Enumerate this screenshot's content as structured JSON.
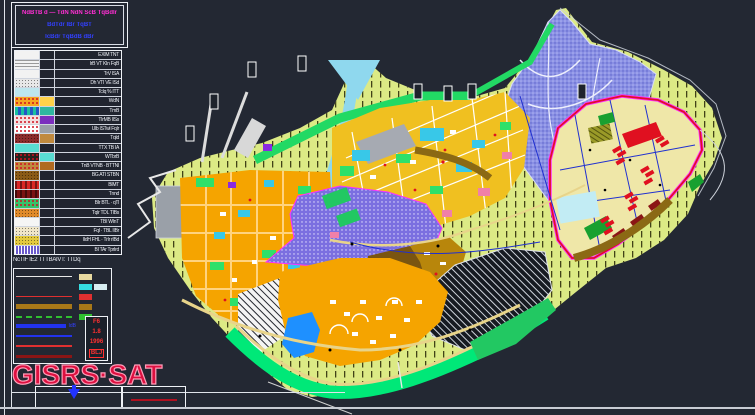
{
  "sheet": {
    "background": "#232833",
    "frame_color": "#e4e8ef"
  },
  "title_block": {
    "line1": "NdBTB d — TdN NdN ScB TqBdIr",
    "line2": "BdTdr IBr TqBT",
    "line3": "IcBdr TqBdB dBr",
    "line1_color": "#ff2fd4",
    "line23_color": "#3240ff"
  },
  "legend": {
    "rows": [
      {
        "c1": "#f2f2f2",
        "p1": "plain",
        "c2": null,
        "label": "EXIM TNT"
      },
      {
        "c1": "#f2f2f2",
        "p1": "hlines",
        "c2": null,
        "label": "IrB VT KIn FqB"
      },
      {
        "c1": "#f2f2f2",
        "p1": "plain",
        "c2": null,
        "label": "TrV ISA"
      },
      {
        "c1": "#e8e8e8",
        "p1": "stipple",
        "c2": null,
        "label": "Dh VTI VE ISd"
      },
      {
        "c1": "#bde6ee",
        "p1": "plain",
        "c2": null,
        "label": "TcIq % ITT"
      },
      {
        "c1": "#f5a623",
        "p1": "reddots",
        "c2": "#ffd24a",
        "label": "WdN"
      },
      {
        "c1": "#2457c5",
        "p1": "mixed",
        "c2": "#2fb7a0",
        "label": "TmB"
      },
      {
        "c1": "#f3dede",
        "p1": "reddots",
        "c2": "#7b2fbe",
        "label": "TIrMB IISs"
      },
      {
        "c1": "#ffffff",
        "p1": "reddots",
        "c2": "#9aa0a8",
        "label": "Ulb ISTwl FqIr"
      },
      {
        "c1": "#8c2b2b",
        "p1": "stipple",
        "c2": "#c08a3e",
        "label": "TqId"
      },
      {
        "c1": "#59dcd2",
        "p1": "plain",
        "c2": null,
        "label": "TTX TB IA"
      },
      {
        "c1": "#27221e",
        "p1": "reddots",
        "c2": "#59dcd2",
        "label": "WTbrB"
      },
      {
        "c1": "#c08a3e",
        "p1": "reddots",
        "c2": "#b06a20",
        "label": "TnB VTNB · BTTNI"
      },
      {
        "c1": "#8a5a16",
        "p1": "stipple",
        "c2": null,
        "label": "BG ATI STBN"
      },
      {
        "c1": "#d92525",
        "p1": "blocks",
        "c2": null,
        "label": "BIMT"
      },
      {
        "c1": "#7a1212",
        "p1": "blocks",
        "c2": null,
        "label": "Tnnd"
      },
      {
        "c1": "#36c36a",
        "p1": "reddots",
        "c2": null,
        "label": "BIr BTL · qTl"
      },
      {
        "c1": "#e08a2a",
        "p1": "stipple",
        "c2": null,
        "label": "TqIr TDL TIBs"
      },
      {
        "c1": "#f5f5f5",
        "p1": "plain",
        "c2": null,
        "label": "TBI WInT"
      },
      {
        "c1": "#f0e6c8",
        "p1": "stipple",
        "c2": null,
        "label": "FqI · TBL IIBr"
      },
      {
        "c1": "#e3c93e",
        "p1": "stipple",
        "c2": null,
        "label": "IIdH FHL · TrIr rIBd"
      },
      {
        "c1": "#6a5acd",
        "p1": "vstripes",
        "c2": null,
        "label": "BI TAr TprIrd"
      }
    ]
  },
  "legend2": {
    "caption": "NcTIF IE2 TTTBAIVT: TTDq",
    "items": [
      {
        "line": "#e8e8e8",
        "weight": 1,
        "style": "solid",
        "chip1": "#e8d9a0",
        "chip2": null,
        "note": ""
      },
      {
        "line": null,
        "weight": 0,
        "style": "none",
        "chip1": "#35dde0",
        "chip2": "#d8eef2",
        "note": ""
      },
      {
        "line": "#e03030",
        "weight": 1,
        "style": "solid",
        "chip1": "#e03030",
        "chip2": null,
        "note": ""
      },
      {
        "line": "#a87818",
        "weight": 5,
        "style": "solid",
        "chip1": "#a87818",
        "chip2": null,
        "note": ""
      },
      {
        "line": "#30c030",
        "weight": 2,
        "style": "dash",
        "chip1": "#30c030",
        "chip2": null,
        "note": ""
      },
      {
        "line": "#2233ee",
        "weight": 4,
        "style": "solid",
        "chip1": null,
        "chip2": null,
        "note": "IdB"
      },
      {
        "line": "#2233ee",
        "weight": 2,
        "style": "solid",
        "chip1": null,
        "chip2": null,
        "note": ""
      },
      {
        "line": "#e03030",
        "weight": 2,
        "style": "solid",
        "chip1": null,
        "chip2": null,
        "note": ""
      },
      {
        "line": "#8b1515",
        "weight": 3,
        "style": "solid",
        "chip1": null,
        "chip2": null,
        "note": ""
      }
    ],
    "stamp": {
      "lines": [
        "F6",
        "1.8",
        "1996",
        "BLJ"
      ],
      "color": "#ff3030"
    }
  },
  "watermark": {
    "text": "GISRS·SAT",
    "color": "#dd1040",
    "outline": "#ff9db8"
  },
  "map": {
    "palette": {
      "sea": "#232833",
      "land": "#dcea85",
      "hill_periwinkle": "#8a90e4",
      "orange_district": "#f5a400",
      "yellow_district": "#f0c020",
      "khaki_district": "#efe7a8",
      "green_band": "#00e878",
      "river": "#8fd8ee",
      "lake": "#1e90ff",
      "industrial_dark": "#161a21",
      "brown_dark": "#7a5510",
      "brown_light": "#b8860b",
      "red_blocks": "#e01020",
      "boundary_magenta": "#ff30ff",
      "road_yellow": "#e8d48a",
      "gray_block": "#9aa0a8"
    }
  }
}
